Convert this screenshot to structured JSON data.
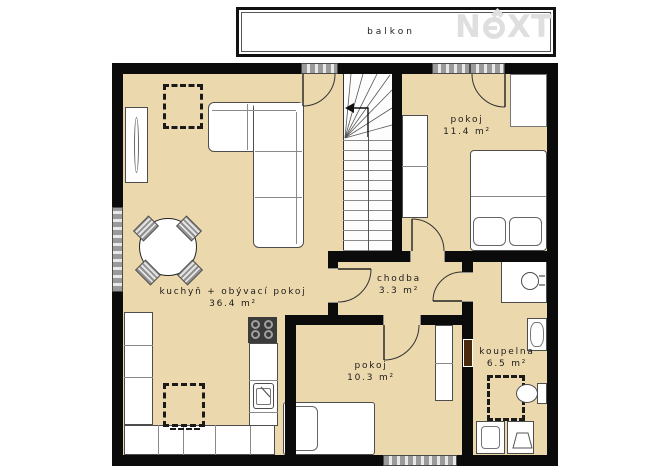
{
  "balcony": {
    "label": "balkon"
  },
  "logo": {
    "pre": "N",
    "circled_letter": "e",
    "post": "XT"
  },
  "rooms": {
    "living": {
      "label": "kuchyň + obývací pokoj",
      "area": "36.4 m²"
    },
    "bedroom_top": {
      "label": "pokoj",
      "area": "11.4 m²"
    },
    "hallway": {
      "label": "chodba",
      "area": "3.3 m²"
    },
    "bedroom_bottom": {
      "label": "pokoj",
      "area": "10.3 m²"
    },
    "bathroom": {
      "label": "koupelna",
      "area": "6.5 m²"
    }
  },
  "colors": {
    "floor": "#ecd8ad",
    "wall": "#0b0b0b",
    "stair_floor": "#fdfdfd",
    "fixture_fill": "#ffffff",
    "fixture_outline": "#4d4d4d",
    "window_hatch": "#9a9a9a",
    "stove": "#3b3b3b",
    "radiator": "#4a2a0e",
    "logo_gray": "#dfdfdf",
    "text": "#1c1c1c"
  }
}
